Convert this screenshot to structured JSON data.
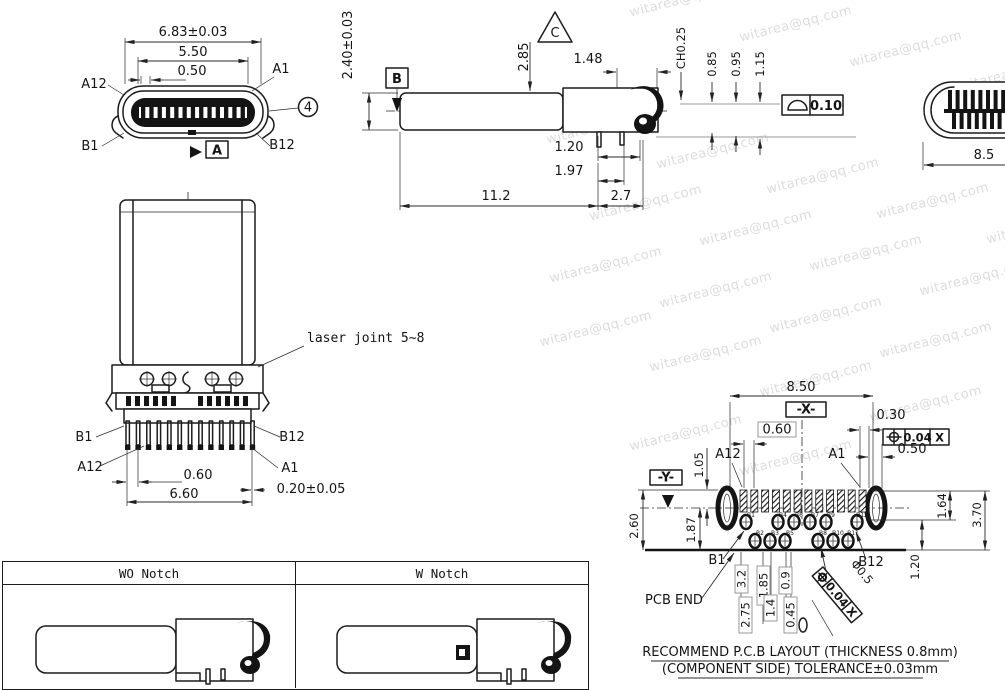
{
  "watermark": {
    "text": "witarea@qq.com"
  },
  "front_view": {
    "dim_width": "6.83±0.03",
    "dim_inner": "5.50",
    "dim_pitch": "0.50",
    "label_a12": "A12",
    "label_a1": "A1",
    "label_b1": "B1",
    "label_b12": "B12",
    "balloon": "4",
    "datum_a": "A"
  },
  "side_view": {
    "dim_height": "2.40±0.03",
    "datum_b": "B",
    "rev_c": "C",
    "dim_d285": "2.85",
    "dim_d148": "1.48",
    "dim_ch": "CH0.25",
    "dim_d085": "0.85",
    "dim_d095": "0.95",
    "dim_d115": "1.15",
    "fcf_value": "0.10",
    "dim_d120": "1.20",
    "dim_d197": "1.97",
    "dim_d112": "11.2",
    "dim_d27": "2.7"
  },
  "right_view": {
    "dim_d85": "8.5"
  },
  "plug_view": {
    "note": "laser joint 5~8",
    "label_b1": "B1",
    "label_b12": "B12",
    "label_a12": "A12",
    "label_a1": "A1",
    "dim_d060": "0.60",
    "dim_tol": "0.20±0.05",
    "dim_d660": "6.60"
  },
  "notch_table": {
    "col1": "WO Notch",
    "col2": "W Notch"
  },
  "pcb_view": {
    "dim_d850": "8.50",
    "datum_x": "-X-",
    "datum_y": "-Y-",
    "dim_d060": "0.60",
    "dim_d030": "0.30",
    "dim_d050": "0.50",
    "fcf1_value": "0.04",
    "fcf1_datum": "X",
    "dim_d105": "1.05",
    "label_a12": "A12",
    "label_a1": "A1",
    "dim_d260": "2.60",
    "dim_d187": "1.87",
    "dim_d164": "1.64",
    "dim_d370": "3.70",
    "dim_d120": "1.20",
    "label_b1": "B1",
    "label_b12": "B12",
    "pcb_end": "PCB END",
    "dim_d32": "3.2",
    "dim_d185": "1.85",
    "dim_d09": "0.9",
    "dim_d275": "2.75",
    "dim_d14": "1.4",
    "dim_d045": "0.45",
    "dim_dia": "Φ0.5",
    "fcf2_value": "0.04",
    "fcf2_datum": "X",
    "pad_labels_top": [
      "B1",
      "B4",
      "B6",
      "B7",
      "B9",
      "B12"
    ],
    "pad_labels_bottom": [
      "B2",
      "B3",
      "B5",
      "B8",
      "B10",
      "B11"
    ],
    "title_line1": "RECOMMEND P.C.B LAYOUT (THICKNESS 0.8mm)",
    "title_line2": "(COMPONENT SIDE) TOLERANCE±0.03mm"
  }
}
